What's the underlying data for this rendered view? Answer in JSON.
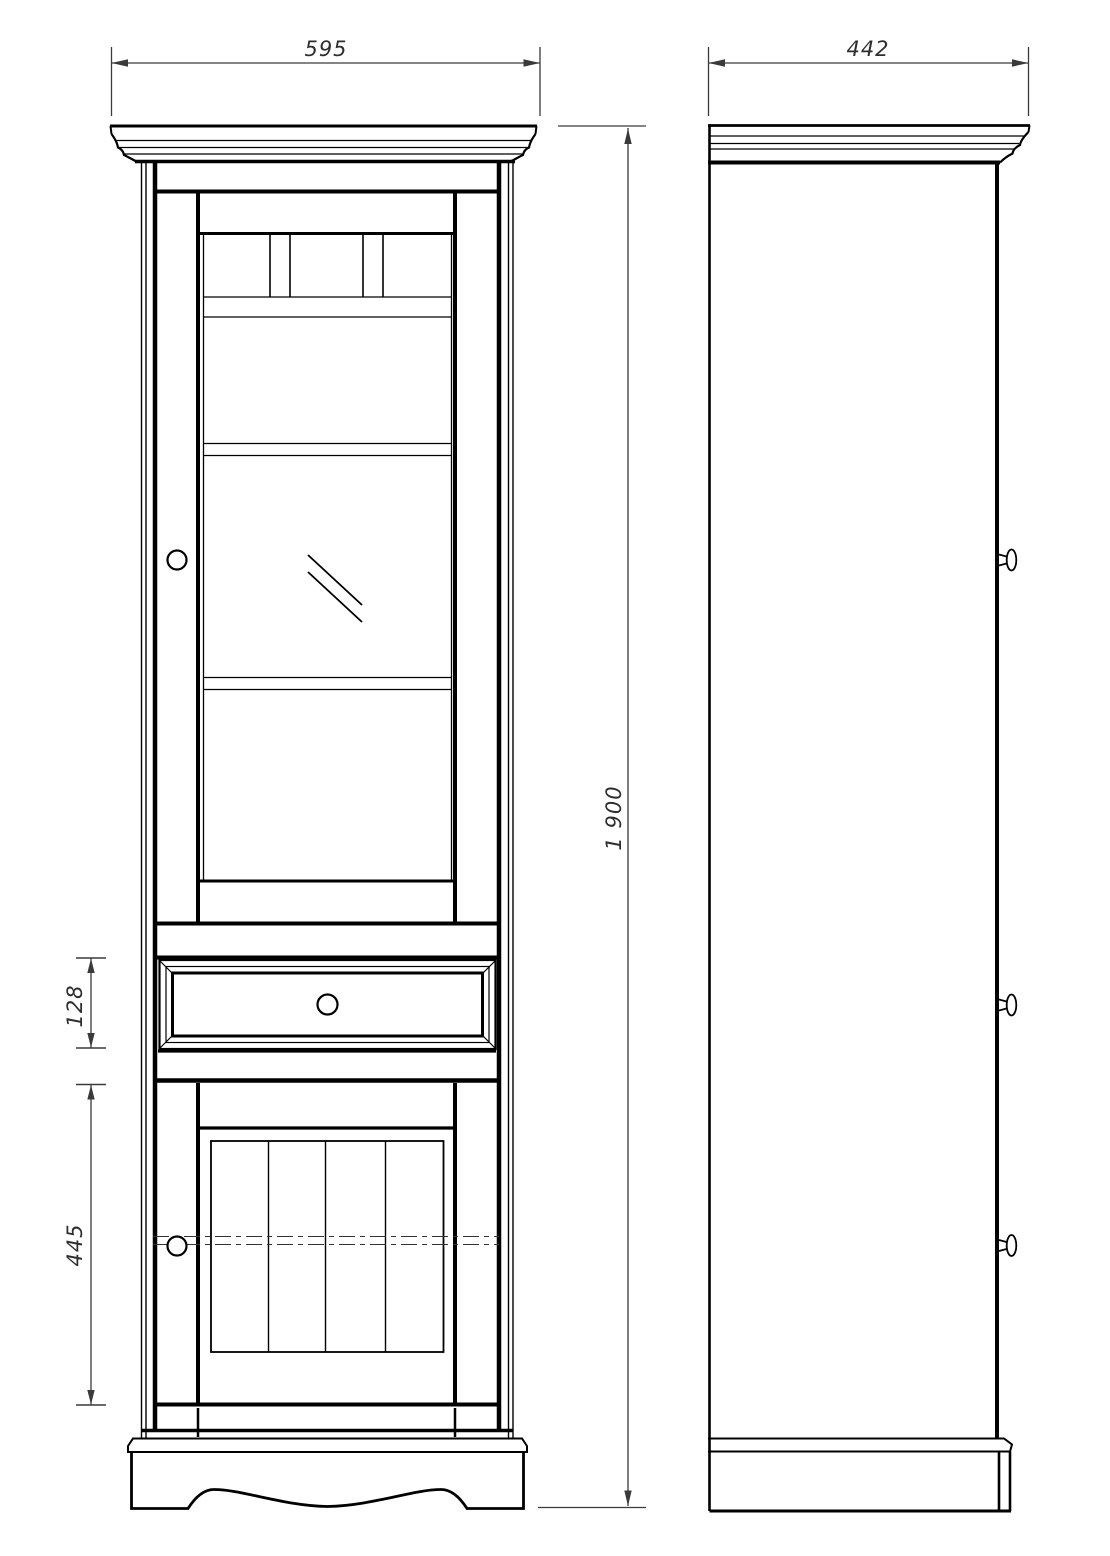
{
  "dimensions": {
    "front_width": "595",
    "side_depth": "442",
    "overall_height": "1 900",
    "drawer_height": "128",
    "lower_door_height": "445"
  },
  "colors": {
    "geometry_line": "#000000",
    "dimension_line": "#3a3a3a",
    "background": "#ffffff"
  }
}
